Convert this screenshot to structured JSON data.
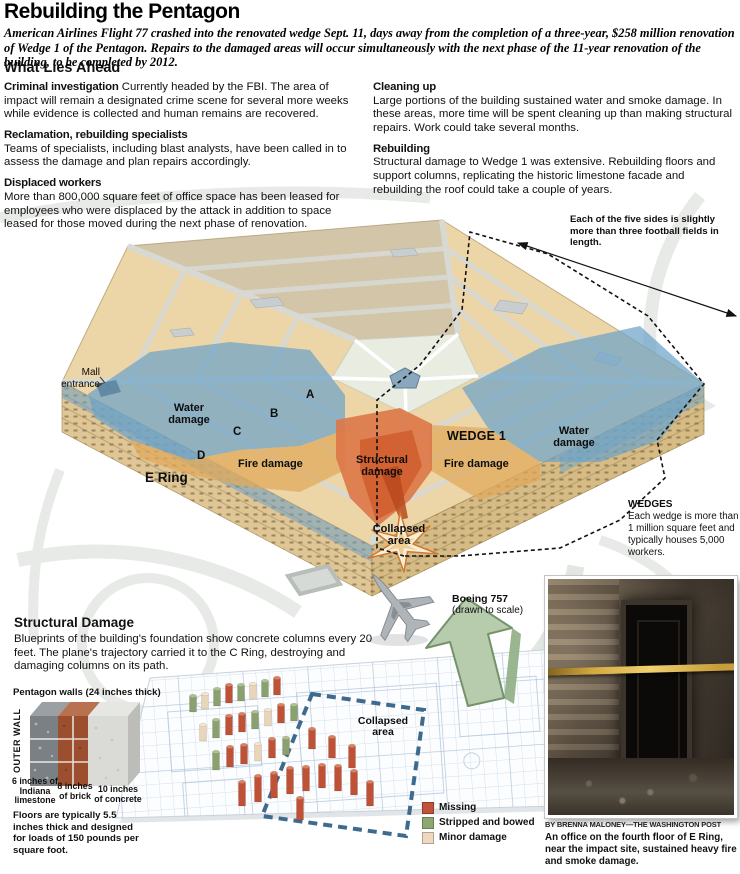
{
  "header": {
    "title": "Rebuilding the Pentagon",
    "intro": "American Airlines Flight 77 crashed into the renovated wedge Sept. 11, days away from the completion of a three-year, $258 million renovation of Wedge 1 of the Pentagon. Repairs to the damaged areas will occur simultaneously with the next phase of the 11-year renovation of the building, to be completed by 2012."
  },
  "what_lies_ahead": {
    "heading": "What Lies Ahead",
    "left": [
      {
        "label": "Criminal investigation",
        "text": "Currently headed by the FBI. The area of impact will remain a designated crime scene for several more weeks while evidence is collected and human remains are recovered."
      },
      {
        "label": "Reclamation, rebuilding specialists",
        "text": "Teams of specialists, including blast analysts, have been called in to assess the damage and plan repairs accordingly."
      },
      {
        "label": "Displaced workers",
        "text": "More than 800,000 square feet of office space has been leased for employees who were displaced by the attack in addition to space leased for those moved during the next phase of renovation."
      }
    ],
    "right": [
      {
        "label": "Cleaning up",
        "text": "Large portions of the building sustained water and smoke damage. In these areas, more time will be spent cleaning up than making structural repairs. Work could take several months."
      },
      {
        "label": "Rebuilding",
        "text": "Structural damage to Wedge 1 was extensive. Rebuilding floors and support columns, replicating the historic limestone facade and rebuilding the roof could take a couple of years."
      }
    ]
  },
  "pentagon": {
    "sides_note": "Each of the five sides is slightly more than three football fields in length.",
    "labels": {
      "mall_entrance": "Mall entrance",
      "water_damage_left": "Water damage",
      "water_damage_right": "Water damage",
      "fire_damage_left": "Fire damage",
      "fire_damage_right": "Fire damage",
      "structural_damage": "Structural damage",
      "collapsed_area": "Collapsed area",
      "e_ring": "E Ring",
      "wedge1": "WEDGE 1",
      "ring_a": "A",
      "ring_b": "B",
      "ring_c": "C",
      "ring_d": "D"
    },
    "heliport_label": "H",
    "wedges_note_title": "WEDGES",
    "wedges_note": "Each wedge is more than 1 million square feet and typically houses 5,000 workers.",
    "plane_label": "Boeing 757",
    "plane_sublabel": "(drawn to scale)"
  },
  "structural_damage": {
    "heading": "Structural Damage",
    "text": "Blueprints of the building's foundation show concrete columns every 20 feet. The plane's trajectory carried it to the C Ring, destroying and damaging columns on its path.",
    "walls": {
      "heading": "Pentagon walls (24 inches thick)",
      "outer_wall_label": "OUTER WALL",
      "layers": [
        {
          "label": "6 inches of Indiana limestone"
        },
        {
          "label": "8 inches of brick"
        },
        {
          "label": "10 inches of concrete"
        }
      ],
      "floors_note": "Floors are typically 5.5 inches thick and designed for loads of 150 pounds per square foot."
    },
    "collapsed_area_label": "Collapsed area",
    "legend": [
      {
        "label": "Missing",
        "color": "#c0533a"
      },
      {
        "label": "Stripped and bowed",
        "color": "#8fa871"
      },
      {
        "label": "Minor damage",
        "color": "#f0d7c0"
      }
    ]
  },
  "photo": {
    "credit": "BY BRENNA MALONEY—THE WASHINGTON POST",
    "caption": "An office on the fourth floor of E Ring, near the impact site, sustained heavy fire and smoke damage."
  },
  "colors": {
    "water_damage": "#6ea3c8",
    "fire_damage": "#e2a95c",
    "structural_damage": "#dd7747",
    "roof_tan": "#ecd5a7",
    "blueprint_dash": "#3e6a8e",
    "arrow_green": "#b7cbad"
  }
}
